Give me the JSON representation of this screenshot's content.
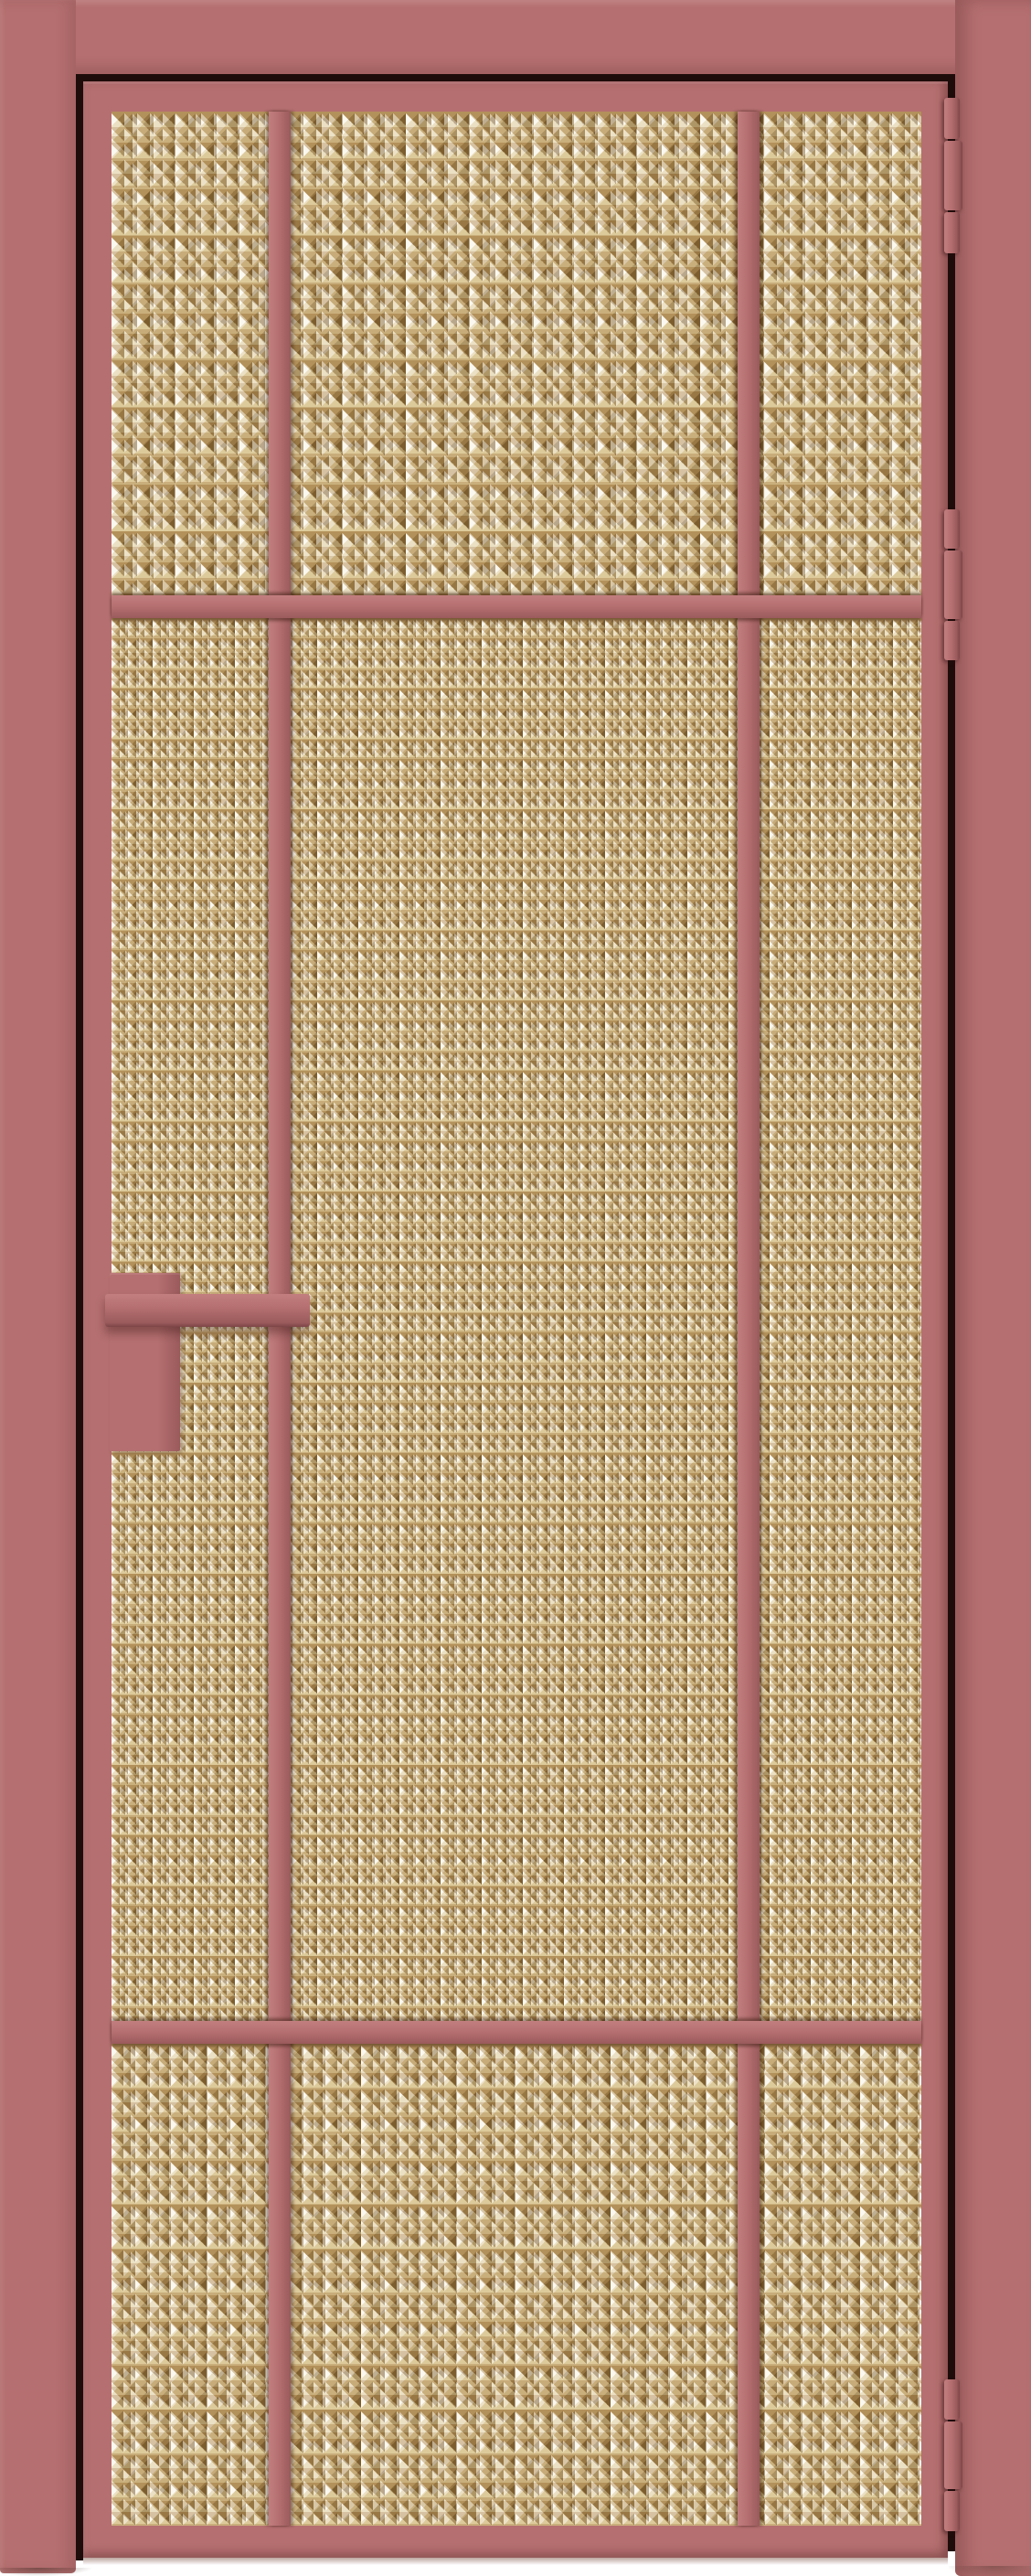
{
  "scene": {
    "description": "Straight-on product photo of a closed single-leaf interior door with an antique-rose aluminium frame and amber prism-textured glass, on a white backdrop"
  },
  "colors": {
    "bg": "#ffffff",
    "rose": "#b56f70",
    "rose_light": "#c27e7f",
    "rose_dark": "#9a5a5c",
    "rose_deep": "#7c4547",
    "gap": "#1e0c0a",
    "glass_base": "#c3a368",
    "glass_dark": "#7c5d2e",
    "glass_mid": "#b3915a",
    "glass_light": "#ddca9b",
    "glass_white": "#fbf8ef"
  },
  "door": {
    "frame_finish": "matte antique rose",
    "glass_finish": "amber prism-textured (Moru) glass",
    "glazing_columns": 3,
    "horizontal_glazing_bars": 2,
    "hinge_count": 3,
    "hinge_side": "right",
    "handle_side": "left",
    "parts": {
      "casing": "door casing",
      "leaf": "door leaf",
      "glass": "textured glass infill",
      "muntin_left": "left vertical glazing bar",
      "muntin_right": "right vertical glazing bar",
      "transom_top": "upper horizontal glazing bar",
      "transom_bottom": "lower horizontal glazing bar",
      "hinge_top": "top hinge",
      "hinge_middle": "middle hinge",
      "hinge_bottom": "bottom hinge",
      "handle": "horizontal bar handle",
      "lock_plate": "lock back plate"
    }
  }
}
